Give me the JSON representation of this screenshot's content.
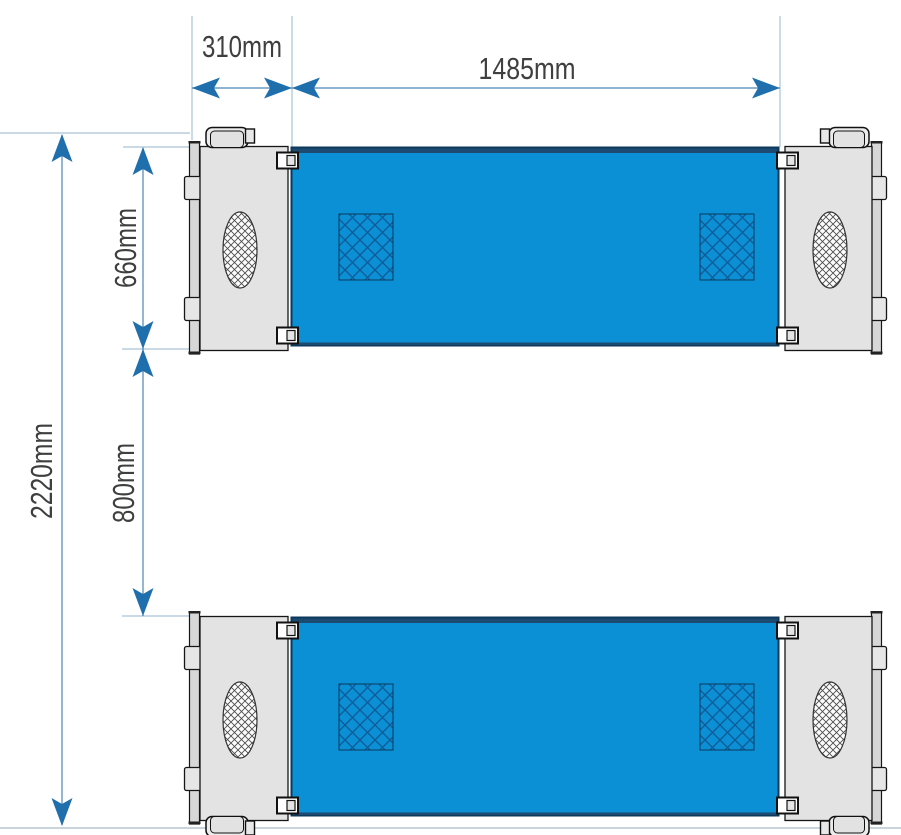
{
  "dimensions": {
    "end_section": "310mm",
    "deck_length": "1485mm",
    "platform_width": "660mm",
    "platform_gap": "800mm",
    "overall_width": "2220mm"
  },
  "colors": {
    "deck_blue": "#0b90d5",
    "deck_edge_navy": "#1c4a70",
    "tread_line_blue": "#0f5c99",
    "plate_gray": "#e3e3e3",
    "outline_black": "#161616",
    "arrow_blue": "#1f6fad",
    "dim_line_blue": "#4d86b3",
    "extension_line_blue": "#a9c4d6",
    "label_gray": "#3f3f3f"
  }
}
